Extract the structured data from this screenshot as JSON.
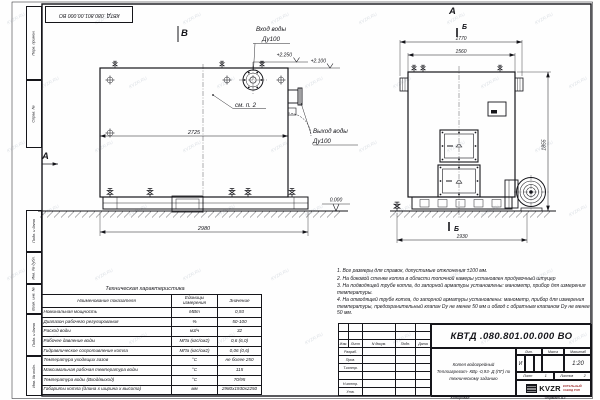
{
  "watermark": "KVZR.RU",
  "stamp_top": "КВТД .080.801.00.000  ВО",
  "frame": {
    "copied": "Копировал",
    "format": "Формат  А3",
    "side_labels": [
      "Перв. примен.",
      "Справ. №",
      "Подп. и дата",
      "Инв. № дубл.",
      "Взам. инв. №",
      "Подп. и дата",
      "Инв. № подл."
    ]
  },
  "views": {
    "side": {
      "title": "В",
      "dir_label": "А",
      "inlet_line1": "Вход воды",
      "inlet_line2": "Ду100",
      "outlet_line1": "Выход воды",
      "outlet_line2": "Ду100",
      "see_note": "см. п. 2",
      "elev_top": "+2.250",
      "elev_mid": "+2.100",
      "elev_zero": "0.000",
      "dim_inner": "2725",
      "dim_total": "2980"
    },
    "front": {
      "title": "А",
      "section": "Б",
      "dim_top": "1770",
      "dim_top2": "1560",
      "dim_height": "1855",
      "dim_width": "1930"
    }
  },
  "tech": {
    "title": "Техническая характеристика",
    "headers": [
      "Наименование показателя",
      "Единицы измерения",
      "Значение"
    ],
    "rows": [
      [
        "Номинальная мощность",
        "МВт",
        "0,93"
      ],
      [
        "Диапазон рабочего регулирования",
        "%",
        "50-100"
      ],
      [
        "Расход воды",
        "м3/ч",
        "32"
      ],
      [
        "Рабочее давление воды",
        "МПа (кгс/см2)",
        "0,6 (6,0)"
      ],
      [
        "Гидравлическое сопротивление котла",
        "МПа (кгс/см2)",
        "0,06 (0,6)"
      ],
      [
        "Температура уходящих газов",
        "°С",
        "не более 250"
      ],
      [
        "Максимальная рабочая температура воды",
        "°С",
        "115"
      ],
      [
        "Температура воды (Вход/выход)",
        "°С",
        "70/95"
      ],
      [
        "Габариты котла (длина х ширина х высота)",
        "мм",
        "2980х1930х2250"
      ]
    ]
  },
  "notes": [
    "1. Все размеры для справок, допустимые отклонения ±100 мм.",
    "2. На боковой стенке котла в области топочной камеры установлен продувочный штуцер",
    "3. На подводящей трубе котла, до запорной арматуры установлены: манометр, прибор для измерения температуры.",
    "4. На отводящей трубе котла, до запорной арматуры установлены: манометр, прибор для измерения температуры, предохранительный клапан Dу не менее 50 мм и обвод с обратным клапаном Dу не менее 50 мм."
  ],
  "titleblock": {
    "doc_number": "КВТД .080.801.00.000  ВО",
    "rev_header": [
      "Изм.",
      "Лист",
      "N докум.",
      "Подп.",
      "Дата"
    ],
    "sign_rows": [
      "Разраб.",
      "Пров.",
      "Т.контр.",
      "",
      "Н.контр.",
      "Утв."
    ],
    "product_lines": [
      "Котел водогрейный",
      "Теплоагрегат- КВр -0,93- Д (ПГ) по",
      "техническому заданию"
    ],
    "lit_label": "Лит.",
    "lit_value": "И",
    "mass_label": "Масса",
    "scale_label": "Масштаб",
    "scale_value": "1:20",
    "sheet_label": "Лист",
    "sheet_value": "1",
    "sheets_label": "Листов",
    "sheets_value": "2",
    "logo_text": "KVZR",
    "logo_sub1": "КОТЕЛЬНЫЙ",
    "logo_sub2": "ЗАВОД РЭП"
  }
}
